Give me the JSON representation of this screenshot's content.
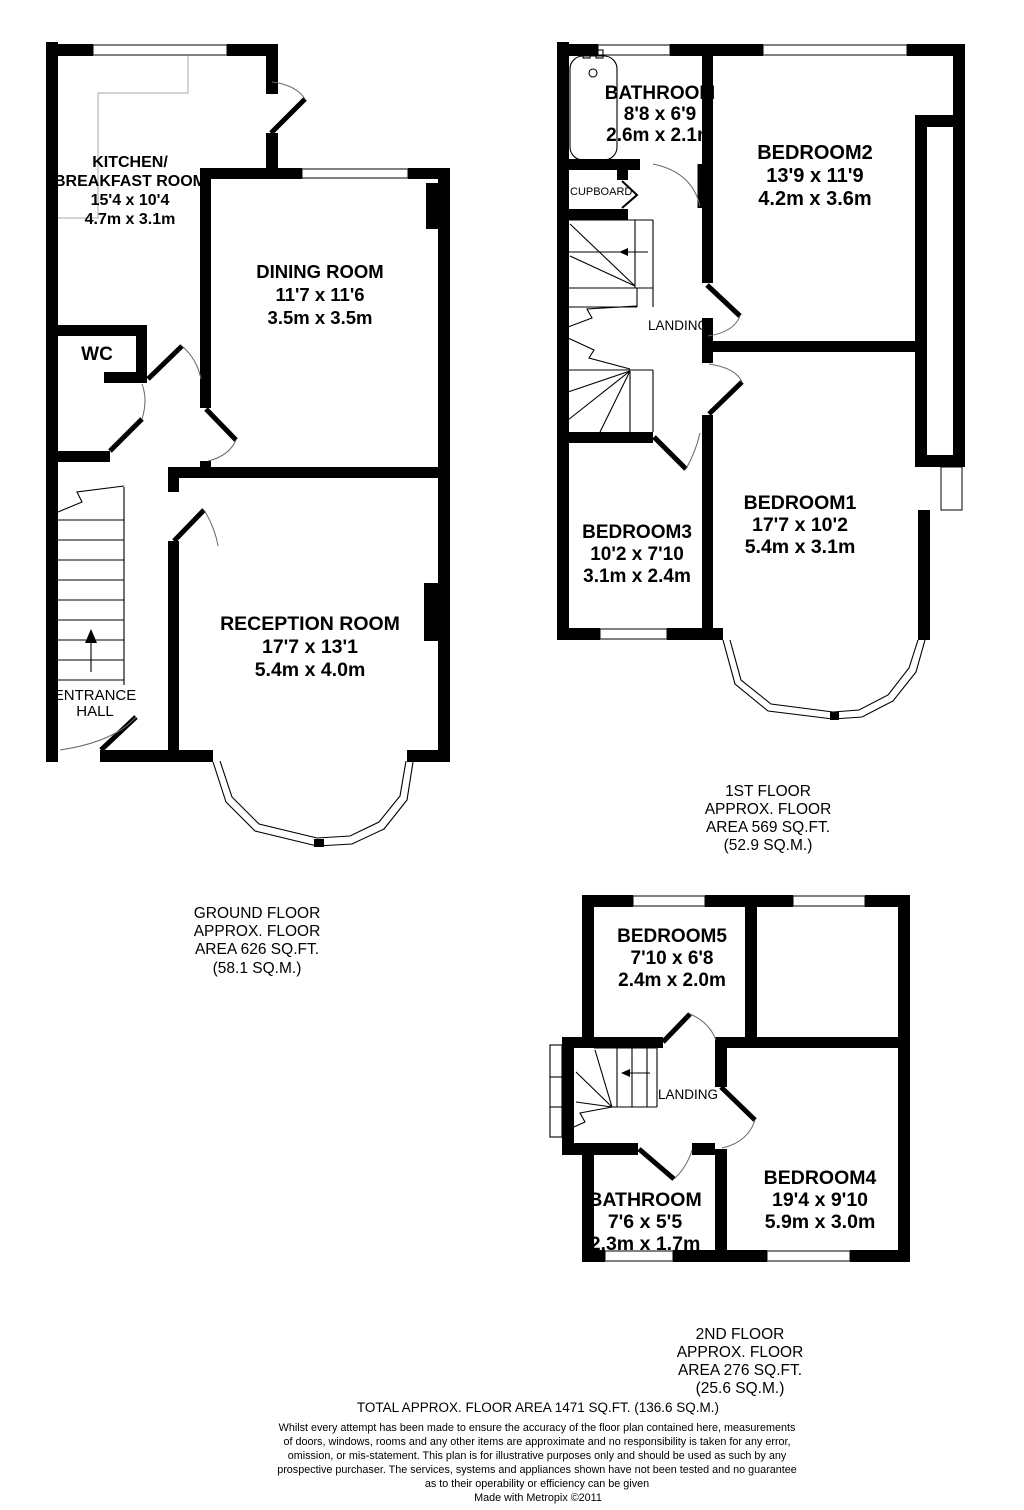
{
  "ground_floor": {
    "rooms": {
      "kitchen": {
        "name_line1": "KITCHEN/",
        "name_line2": "BREAKFAST ROOM",
        "imperial": "15'4 x 10'4",
        "metric": "4.7m x 3.1m"
      },
      "dining_room": {
        "name": "DINING ROOM",
        "imperial": "11'7 x 11'6",
        "metric": "3.5m x 3.5m"
      },
      "wc": {
        "name": "WC"
      },
      "reception_room": {
        "name": "RECEPTION ROOM",
        "imperial": "17'7 x 13'1",
        "metric": "5.4m x 4.0m"
      },
      "entrance_hall": {
        "name_line1": "ENTRANCE",
        "name_line2": "HALL"
      }
    },
    "label": [
      "GROUND FLOOR",
      "APPROX. FLOOR",
      "AREA 626 SQ.FT.",
      "(58.1 SQ.M.)"
    ]
  },
  "first_floor": {
    "rooms": {
      "bathroom": {
        "name": "BATHROOM",
        "imperial": "8'8 x 6'9",
        "metric": "2.6m x 2.1m"
      },
      "cupboard": {
        "name": "CUPBOARD"
      },
      "bedroom2": {
        "name": "BEDROOM2",
        "imperial": "13'9 x 11'9",
        "metric": "4.2m x 3.6m"
      },
      "landing": {
        "name": "LANDING"
      },
      "bedroom3": {
        "name": "BEDROOM3",
        "imperial": "10'2 x 7'10",
        "metric": "3.1m x 2.4m"
      },
      "bedroom1": {
        "name": "BEDROOM1",
        "imperial": "17'7 x 10'2",
        "metric": "5.4m x 3.1m"
      }
    },
    "label": [
      "1ST FLOOR",
      "APPROX. FLOOR",
      "AREA 569 SQ.FT.",
      "(52.9 SQ.M.)"
    ]
  },
  "second_floor": {
    "rooms": {
      "bedroom5": {
        "name": "BEDROOM5",
        "imperial": "7'10 x 6'8",
        "metric": "2.4m x 2.0m"
      },
      "landing": {
        "name": "LANDING"
      },
      "bathroom": {
        "name": "BATHROOM",
        "imperial": "7'6 x 5'5",
        "metric": "2.3m x 1.7m"
      },
      "bedroom4": {
        "name": "BEDROOM4",
        "imperial": "19'4 x 9'10",
        "metric": "5.9m x 3.0m"
      }
    },
    "label": [
      "2ND FLOOR",
      "APPROX. FLOOR",
      "AREA 276 SQ.FT.",
      "(25.6 SQ.M.)"
    ]
  },
  "footer": {
    "total": "TOTAL APPROX. FLOOR AREA 1471 SQ.FT. (136.6 SQ.M.)",
    "disclaimer": [
      "Whilst every attempt has been made to ensure the accuracy of the floor plan contained here, measurements",
      "of doors, windows, rooms and any other items are approximate and no responsibility is taken for any error,",
      "omission, or mis-statement. This plan is for illustrative purposes only and should be used as such by any",
      "prospective purchaser. The services, systems and appliances shown have not been tested and no guarantee",
      "as to their operability or efficiency can be given"
    ],
    "credit": "Made with Metropix ©2011"
  },
  "colors": {
    "wall": "#000000",
    "background": "#ffffff",
    "counter_line": "#a9a9a9",
    "door_arc": "#666666"
  }
}
